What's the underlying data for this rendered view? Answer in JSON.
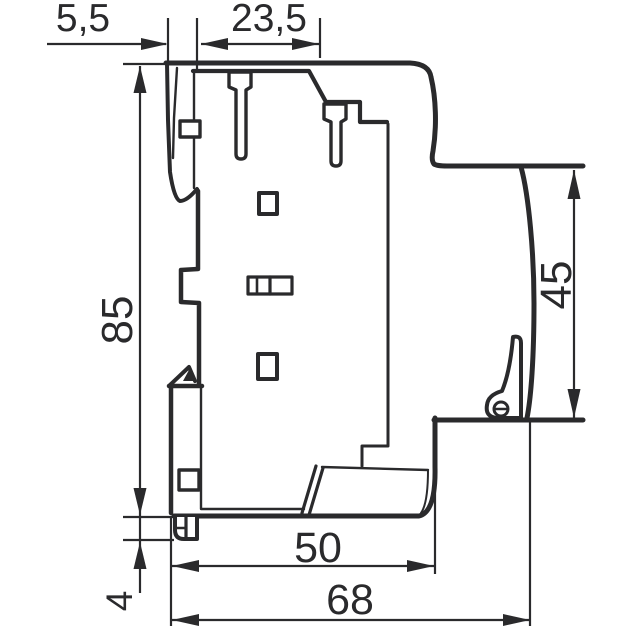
{
  "meta": {
    "background": "#ffffff",
    "ink": "#2a2a2c",
    "drawing_kind": "dimensioned side-view technical drawing of DIN-rail modular device"
  },
  "dimensions": {
    "lip_width": "5,5",
    "terminal_width": "23,5",
    "total_height": "85",
    "rear_height": "45",
    "front_depth": "50",
    "total_depth": "68",
    "foot_height": "4"
  }
}
